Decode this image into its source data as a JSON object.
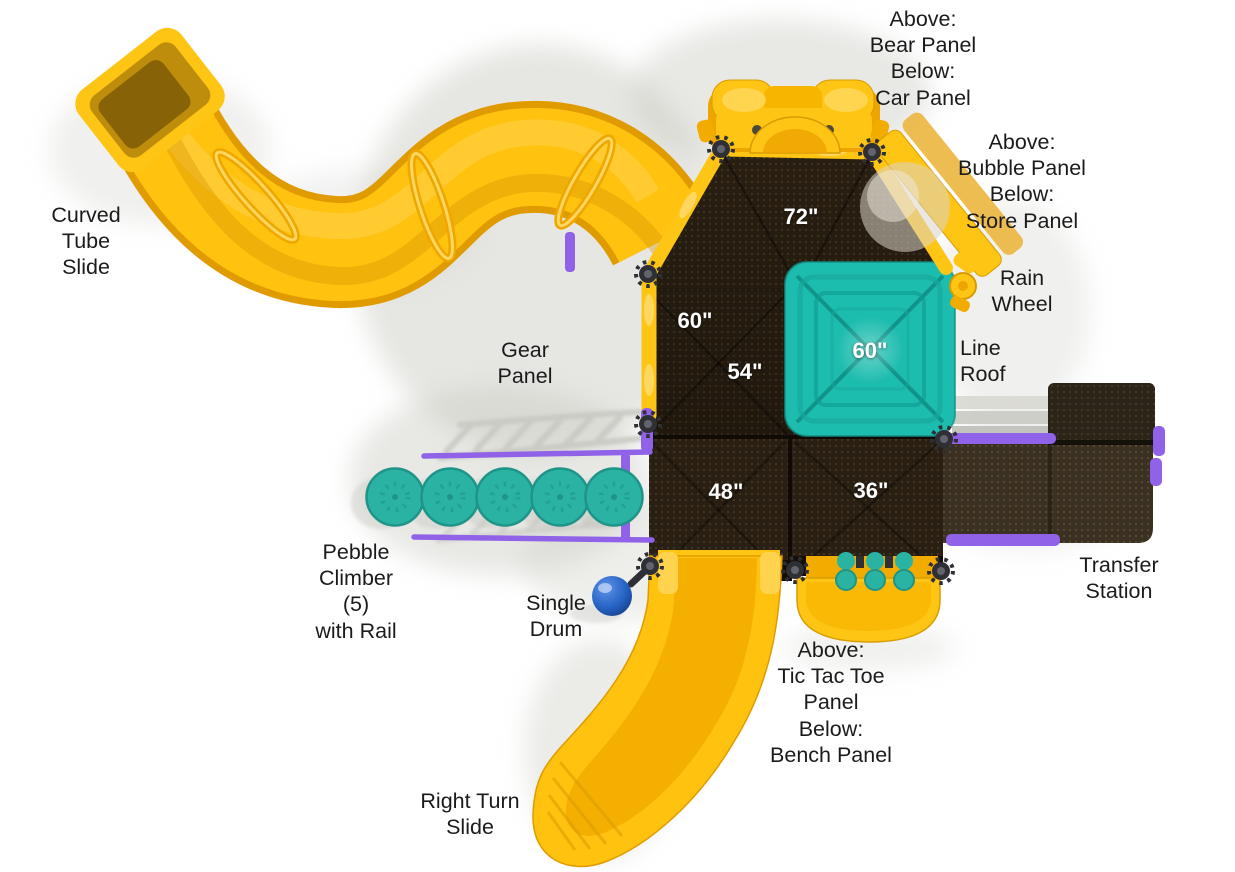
{
  "diagram": {
    "type": "playground-structure-top-view",
    "callouts": {
      "bear_car_panel": "Above:\nBear Panel\nBelow:\nCar Panel",
      "bubble_store_panel": "Above:\nBubble Panel\nBelow:\nStore Panel",
      "curved_tube_slide": "Curved\nTube\nSlide",
      "rain_wheel": "Rain\nWheel",
      "gear_panel": "Gear\nPanel",
      "line_roof": "Line\nRoof",
      "pebble_climber": "Pebble\nClimber\n(5)\nwith Rail",
      "single_drum": "Single\nDrum",
      "transfer_station": "Transfer\nStation",
      "tic_tac_toe_bench_panel": "Above:\nTic Tac Toe\nPanel\nBelow:\nBench Panel",
      "right_turn_slide": "Right Turn\nSlide"
    },
    "measurements": {
      "deck_72": "72\"",
      "deck_60_left": "60\"",
      "deck_54": "54\"",
      "roof_60": "60\"",
      "deck_48": "48\"",
      "deck_36": "36\""
    },
    "colors": {
      "slide_yellow": "#FFC20E",
      "yellow_shade": "#E9A303",
      "yellow_light": "#FFD75E",
      "deck_brown": "#291F12",
      "roof_teal": "#1CBCAE",
      "pebble_teal": "#2AB3A3",
      "rail_purple": "#8F62E8",
      "drum_blue": "#1D54B0",
      "clamp_gray": "#2F2F36",
      "label_text": "#1B1B1B",
      "measurement_text": "#FFFFFF",
      "background": "#FFFFFF"
    }
  }
}
